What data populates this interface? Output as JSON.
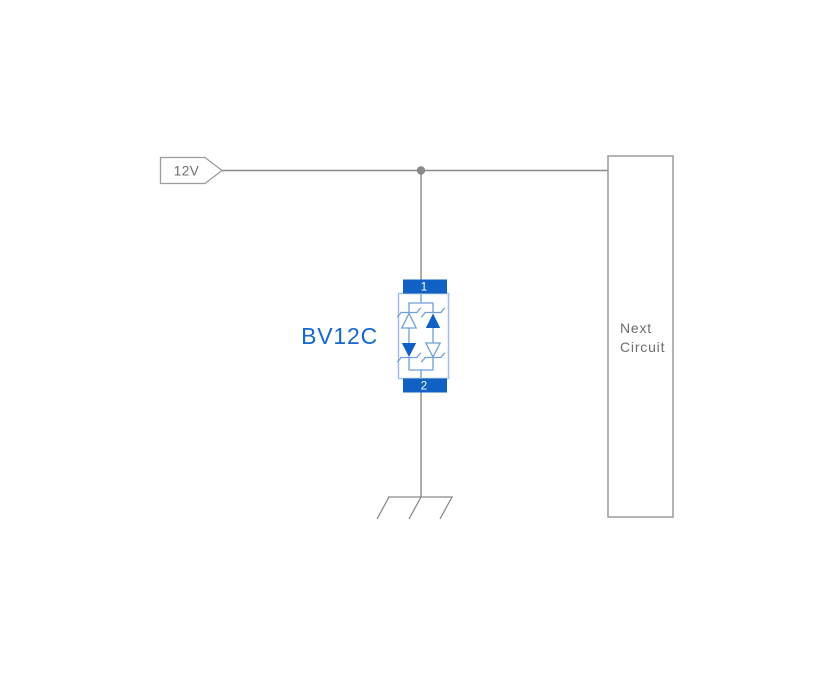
{
  "diagram": {
    "power_net": {
      "label": "12V"
    },
    "component": {
      "label": "BV12C",
      "pins": {
        "top": "1",
        "bottom": "2"
      }
    },
    "next_circuit": {
      "line1": "Next",
      "line2": "Circuit"
    },
    "icons": {
      "junction": "wire-junction-dot",
      "ground": "chassis-ground-symbol",
      "net_flag": "power-net-flag",
      "tvs": "bidirectional-tvs-diode-symbol"
    },
    "colors": {
      "background": "#ffffff",
      "wire": "#8a8a8a",
      "outline": "#9b9b9b",
      "text_gray": "#6d6d6d",
      "component_fill": "#1161c5",
      "component_outline": "#a3c0e4",
      "component_inner": "#6f9fd8",
      "label_blue": "#1668cf",
      "pin_text": "#ffffff"
    }
  }
}
